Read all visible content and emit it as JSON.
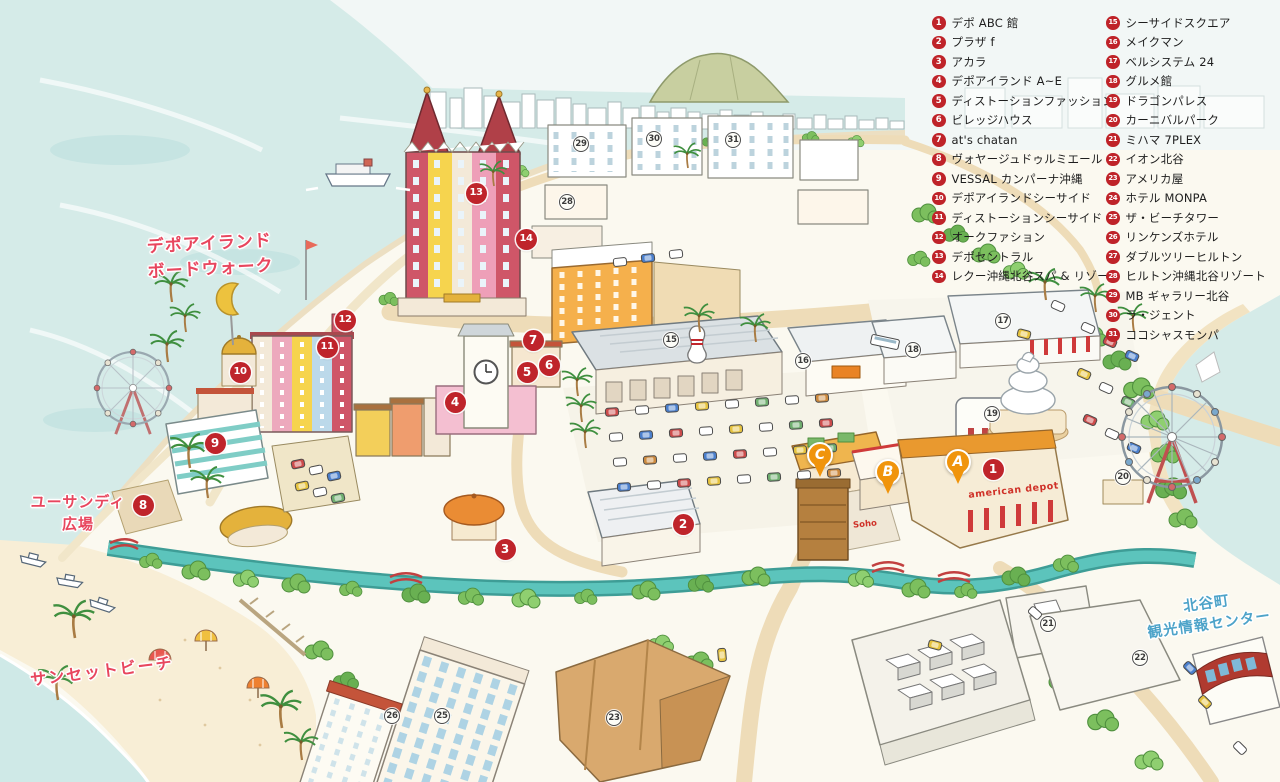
{
  "legend": {
    "items_left": [
      {
        "num": "1",
        "label": "デポ ABC 館"
      },
      {
        "num": "2",
        "label": "プラザ f"
      },
      {
        "num": "3",
        "label": "アカラ"
      },
      {
        "num": "4",
        "label": "デポアイランド A~E"
      },
      {
        "num": "5",
        "label": "ディストーションファッション"
      },
      {
        "num": "6",
        "label": "ビレッジハウス"
      },
      {
        "num": "7",
        "label": "at's chatan"
      },
      {
        "num": "8",
        "label": "ヴォヤージュドゥルミエール"
      },
      {
        "num": "9",
        "label": "VESSAL カンパーナ沖縄"
      },
      {
        "num": "10",
        "label": "デポアイランドシーサイド"
      },
      {
        "num": "11",
        "label": "ディストーションシーサイド"
      },
      {
        "num": "12",
        "label": "オークファション"
      },
      {
        "num": "13",
        "label": "デポセントラル"
      },
      {
        "num": "14",
        "label": "レクー沖縄北谷スパ & リゾート"
      }
    ],
    "items_right": [
      {
        "num": "15",
        "label": "シーサイドスクエア"
      },
      {
        "num": "16",
        "label": "メイクマン"
      },
      {
        "num": "17",
        "label": "ベルシステム 24"
      },
      {
        "num": "18",
        "label": "グルメ館"
      },
      {
        "num": "19",
        "label": "ドラゴンパレス"
      },
      {
        "num": "20",
        "label": "カーニバルパーク"
      },
      {
        "num": "21",
        "label": "ミハマ 7PLEX"
      },
      {
        "num": "22",
        "label": "イオン北谷"
      },
      {
        "num": "23",
        "label": "アメリカ屋"
      },
      {
        "num": "24",
        "label": "ホテル MONPA"
      },
      {
        "num": "25",
        "label": "ザ・ビーチタワー"
      },
      {
        "num": "26",
        "label": "リンケンズホテル"
      },
      {
        "num": "27",
        "label": "ダブルツリーヒルトン"
      },
      {
        "num": "28",
        "label": "ヒルトン沖縄北谷リゾート"
      },
      {
        "num": "29",
        "label": "MB ギャラリー北谷"
      },
      {
        "num": "30",
        "label": "ラ・ジェント"
      },
      {
        "num": "31",
        "label": "ココシャスモンパ"
      }
    ]
  },
  "map_labels": {
    "boardwalk": {
      "line1": "デポアイランド",
      "line2": "ボードウォーク"
    },
    "yuusandy": {
      "line1": "ユーサンディ",
      "line2": "広場"
    },
    "sunset_beach": {
      "line1": "サンセットビーチ"
    },
    "info_center": {
      "line1": "北谷町",
      "line2": "観光情報センター"
    }
  },
  "building_labels": {
    "american_depot": "american depot",
    "soho": "Soho"
  },
  "markers": {
    "red": [
      {
        "num": "1",
        "x": 993,
        "y": 469
      },
      {
        "num": "2",
        "x": 683,
        "y": 524
      },
      {
        "num": "3",
        "x": 505,
        "y": 549
      },
      {
        "num": "4",
        "x": 455,
        "y": 402
      },
      {
        "num": "5",
        "x": 527,
        "y": 372
      },
      {
        "num": "6",
        "x": 549,
        "y": 365
      },
      {
        "num": "7",
        "x": 533,
        "y": 340
      },
      {
        "num": "8",
        "x": 143,
        "y": 505
      },
      {
        "num": "9",
        "x": 215,
        "y": 443
      },
      {
        "num": "10",
        "x": 240,
        "y": 372
      },
      {
        "num": "11",
        "x": 327,
        "y": 347
      },
      {
        "num": "12",
        "x": 345,
        "y": 320
      },
      {
        "num": "13",
        "x": 476,
        "y": 193
      },
      {
        "num": "14",
        "x": 526,
        "y": 239
      }
    ],
    "outline": [
      {
        "num": "15",
        "x": 671,
        "y": 340
      },
      {
        "num": "16",
        "x": 803,
        "y": 361
      },
      {
        "num": "17",
        "x": 1003,
        "y": 321
      },
      {
        "num": "18",
        "x": 913,
        "y": 350
      },
      {
        "num": "19",
        "x": 992,
        "y": 414
      },
      {
        "num": "20",
        "x": 1123,
        "y": 477
      },
      {
        "num": "21",
        "x": 1048,
        "y": 624
      },
      {
        "num": "22",
        "x": 1140,
        "y": 658
      },
      {
        "num": "23",
        "x": 614,
        "y": 718
      },
      {
        "num": "25",
        "x": 442,
        "y": 716
      },
      {
        "num": "26",
        "x": 392,
        "y": 716
      },
      {
        "num": "28",
        "x": 567,
        "y": 202
      },
      {
        "num": "29",
        "x": 581,
        "y": 144
      },
      {
        "num": "30",
        "x": 654,
        "y": 139
      },
      {
        "num": "31",
        "x": 733,
        "y": 140
      }
    ],
    "pins": [
      {
        "letter": "A",
        "x": 958,
        "y": 462
      },
      {
        "letter": "B",
        "x": 888,
        "y": 472
      },
      {
        "letter": "C",
        "x": 820,
        "y": 455
      }
    ]
  },
  "colors": {
    "marker_red": "#bf242b",
    "pin_orange": "#f0940c",
    "label_red": "#e8465e",
    "label_blue": "#4da3c9",
    "ocean": "#d5ebe8",
    "canal": "#5cc4bc",
    "road": "#eedcb8",
    "sand": "#f7ecd2"
  }
}
